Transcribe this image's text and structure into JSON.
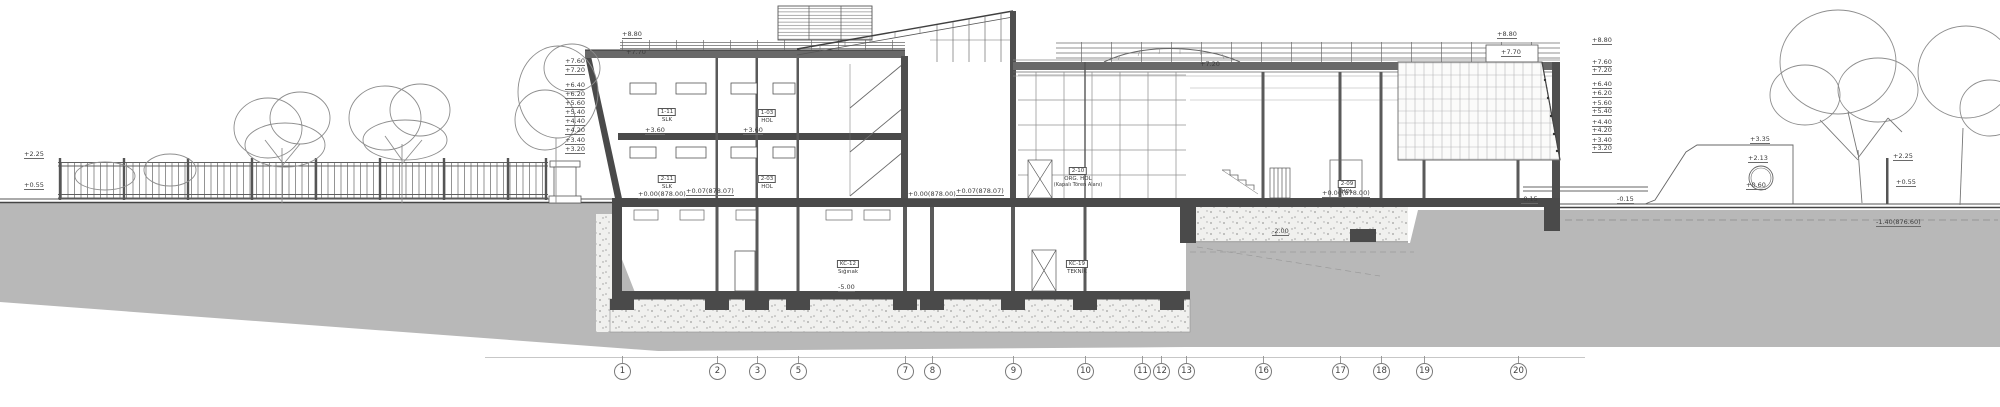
{
  "drawing": {
    "type": "architectural-building-section",
    "colors": {
      "ground": "#b8b8b8",
      "line": "#4a4a4a",
      "slab": "#4a4a4a",
      "light_line": "#9a9a9a",
      "speckle": "#f0f0ee"
    },
    "grid_bubbles": {
      "y": 371,
      "items": [
        {
          "n": "1",
          "x": 622
        },
        {
          "n": "2",
          "x": 717
        },
        {
          "n": "3",
          "x": 757
        },
        {
          "n": "5",
          "x": 798
        },
        {
          "n": "7",
          "x": 905
        },
        {
          "n": "8",
          "x": 932
        },
        {
          "n": "9",
          "x": 1013
        },
        {
          "n": "10",
          "x": 1085
        },
        {
          "n": "11",
          "x": 1142
        },
        {
          "n": "12",
          "x": 1161
        },
        {
          "n": "13",
          "x": 1186
        },
        {
          "n": "16",
          "x": 1263
        },
        {
          "n": "17",
          "x": 1340
        },
        {
          "n": "18",
          "x": 1381
        },
        {
          "n": "19",
          "x": 1424
        },
        {
          "n": "20",
          "x": 1518
        }
      ]
    },
    "elevation_stack_left": {
      "x": 585,
      "align": "right",
      "items": [
        {
          "t": "+7.60",
          "y": 59
        },
        {
          "t": "+7.20",
          "y": 68
        },
        {
          "t": "+6.40",
          "y": 83
        },
        {
          "t": "+6.20",
          "y": 92
        },
        {
          "t": "+5.60",
          "y": 101
        },
        {
          "t": "+5.40",
          "y": 110
        },
        {
          "t": "+4.40",
          "y": 119
        },
        {
          "t": "+4.20",
          "y": 128
        },
        {
          "t": "+3.40",
          "y": 138
        },
        {
          "t": "+3.20",
          "y": 147
        }
      ]
    },
    "elevation_stack_right": {
      "x": 1592,
      "align": "left",
      "items": [
        {
          "t": "+8.80",
          "y": 38
        },
        {
          "t": "+7.60",
          "y": 60
        },
        {
          "t": "+7.20",
          "y": 68
        },
        {
          "t": "+6.40",
          "y": 82
        },
        {
          "t": "+6.20",
          "y": 91
        },
        {
          "t": "+5.60",
          "y": 101
        },
        {
          "t": "+5.40",
          "y": 109
        },
        {
          "t": "+4.40",
          "y": 120
        },
        {
          "t": "+4.20",
          "y": 128
        },
        {
          "t": "+3.40",
          "y": 138
        },
        {
          "t": "+3.20",
          "y": 146
        }
      ]
    },
    "annotations": [
      {
        "t": "+8.80",
        "x": 622,
        "y": 32
      },
      {
        "t": "+7.70",
        "x": 626,
        "y": 50
      },
      {
        "t": "+8.80",
        "x": 1497,
        "y": 32
      },
      {
        "t": "+7.70",
        "x": 1501,
        "y": 50
      },
      {
        "t": "+7.20",
        "x": 1200,
        "y": 62
      },
      {
        "t": "+3.60",
        "x": 645,
        "y": 128
      },
      {
        "t": "+3.60",
        "x": 743,
        "y": 128
      },
      {
        "t": "+0.00(878.00)",
        "x": 638,
        "y": 192
      },
      {
        "t": "+0.07(878.07)",
        "x": 686,
        "y": 189
      },
      {
        "t": "+0.00(878.00)",
        "x": 908,
        "y": 192
      },
      {
        "t": "+0.07(878.07)",
        "x": 956,
        "y": 189
      },
      {
        "t": "+0.00(878.00)",
        "x": 1322,
        "y": 191
      },
      {
        "t": "-0.15",
        "x": 1521,
        "y": 197
      },
      {
        "t": "-0.15",
        "x": 1617,
        "y": 197
      },
      {
        "t": "-2.00",
        "x": 1272,
        "y": 229
      },
      {
        "t": "-5.00",
        "x": 838,
        "y": 285
      },
      {
        "t": "-1.40(876.60)",
        "x": 1876,
        "y": 220
      },
      {
        "t": "+3.35",
        "x": 1750,
        "y": 137
      },
      {
        "t": "+2.13",
        "x": 1748,
        "y": 156
      },
      {
        "t": "+0.60",
        "x": 1746,
        "y": 183
      },
      {
        "t": "+2.25",
        "x": 1893,
        "y": 154
      },
      {
        "t": "+0.55",
        "x": 1896,
        "y": 180
      },
      {
        "t": "+2.25",
        "x": 24,
        "y": 152
      },
      {
        "t": "+0.55",
        "x": 24,
        "y": 183
      }
    ],
    "room_labels": [
      {
        "code": "1-11",
        "name": "SLK",
        "x": 667,
        "y": 99
      },
      {
        "code": "1-03",
        "name": "HOL",
        "x": 767,
        "y": 100
      },
      {
        "code": "2-11",
        "name": "SLK",
        "x": 667,
        "y": 166
      },
      {
        "code": "2-03",
        "name": "HOL",
        "x": 767,
        "y": 166
      },
      {
        "code": "2-10",
        "name": "ORG. HOL",
        "extra": "(Kapalı Tören Alanı)",
        "x": 1078,
        "y": 158
      },
      {
        "code": "2-09",
        "name": "HOL",
        "x": 1347,
        "y": 171
      },
      {
        "code": "KC-12",
        "name": "Sığınak",
        "x": 848,
        "y": 251
      },
      {
        "code": "KC-19",
        "name": "TEKNİK",
        "x": 1077,
        "y": 251
      }
    ]
  }
}
